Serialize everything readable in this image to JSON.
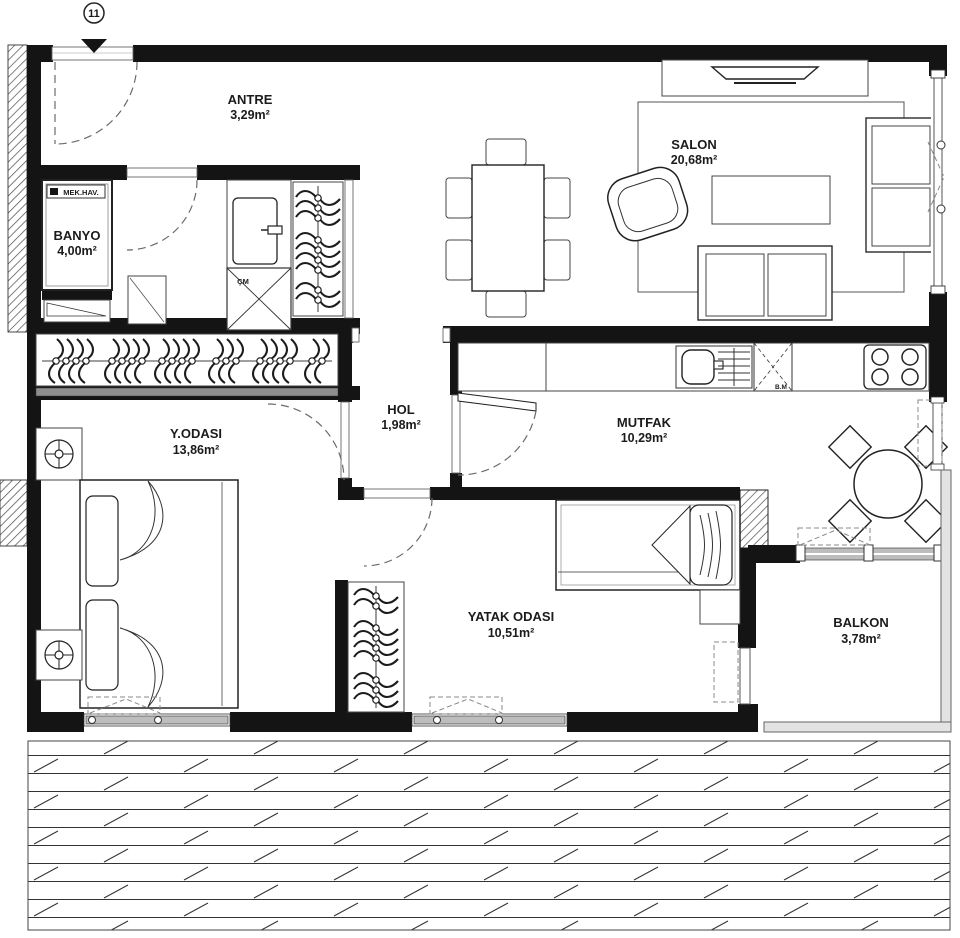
{
  "plan": {
    "marker": {
      "number": "11"
    },
    "rooms": {
      "antre": {
        "name": "ANTRE",
        "area": "3,29m²"
      },
      "salon": {
        "name": "SALON",
        "area": "20,68m²"
      },
      "banyo": {
        "name": "BANYO",
        "area": "4,00m²"
      },
      "hol": {
        "name": "HOL",
        "area": "1,98m²"
      },
      "mutfak": {
        "name": "MUTFAK",
        "area": "10,29m²"
      },
      "yodasi": {
        "name": "Y.ODASI",
        "area": "13,86m²"
      },
      "yatak": {
        "name": "YATAK ODASI",
        "area": "10,51m²"
      },
      "balkon": {
        "name": "BALKON",
        "area": "3,78m²"
      }
    },
    "labels": {
      "mech_vent": "MEK.HAV.",
      "washing_machine": "ÇM",
      "dishwasher": "B.M"
    },
    "colors": {
      "wall": "#141414",
      "line": "#2a2a2a",
      "window_gray": "#bdbdbd",
      "background": "#ffffff"
    }
  }
}
